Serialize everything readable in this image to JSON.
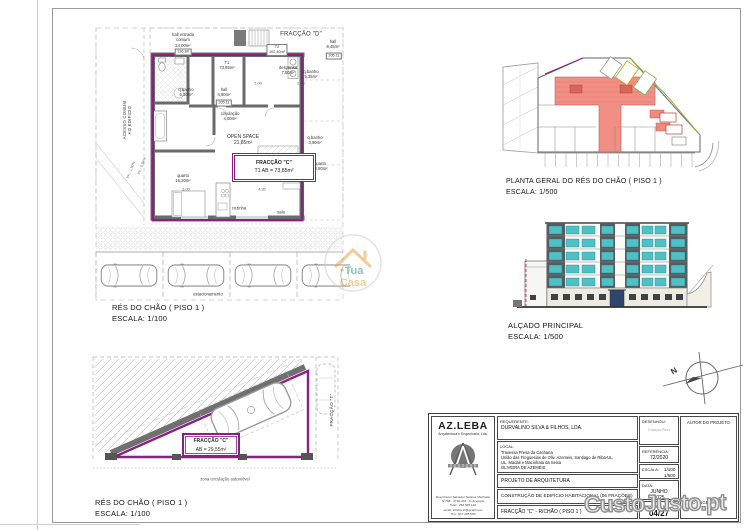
{
  "floorplan": {
    "caption_title": "RÉS DO CHÃO ( PISO 1 )",
    "caption_scale": "ESCALA: 1/100",
    "fraccao_d_title": "FRACÇÃO \"D\"",
    "hall_entrada": "hall entrada\ncomum\n24,00m²",
    "cota_entrada": "136.80",
    "t2_tag": "T2\n102,40m²",
    "t1_tag": "T1\n73,85m²",
    "hall_d": "hall\n6,45m²",
    "cota_hall_d": "205.11",
    "despensa": "despensa\n7,80m²",
    "qbanho_d": "q.banho\n5,35m²",
    "qbanho_d2": "q.banho\n3,90m²",
    "quarto_d": "quarto\n12,80m²",
    "qbanho_c": "q.banho\n6,30m²",
    "hall_c": "hall\n4,90m²",
    "cota_hall_c": "205.11",
    "circulacao": "circulação\n4,00m²",
    "open_space": "OPEN SPACE\n21,85m²",
    "fraccao_c_line1": "FRACÇÃO \"C\"",
    "fraccao_c_line2": "T1  AB = 73,85m²",
    "quarto_c": "quarto\n16,20m²",
    "cozinha": "cozinha",
    "sala": "sala",
    "acesso": "ACESSO COMUM\nAO EDIFÍCIO",
    "inc1": "inc.: 1,90%",
    "inc2": "inc.: 5,94%",
    "estacionamento": "estacionamento",
    "dim1": "2.00",
    "dim2": "2.15",
    "dim3": "3.00",
    "dim4": "4.30"
  },
  "general_plan": {
    "caption_title": "PLANTA GERAL DO RÉS DO CHÃO ( PISO 1 )",
    "caption_scale": "ESCALA: 1/500"
  },
  "elevation": {
    "caption_title": "ALÇADO PRINCIPAL",
    "caption_scale": "ESCALA: 1/500"
  },
  "garage": {
    "caption_title": "RÉS DO CHÃO ( PISO 1 )",
    "caption_scale": "ESCALA: 1/100",
    "fraccao_c_line1": "FRACÇÃO \"C\"",
    "fraccao_c_line2": "AB = 29,55m²",
    "zona": "zona circulação automóvel",
    "fraccao_t": "FRACÇÃO \"T\""
  },
  "north": {
    "label": "N"
  },
  "title_block": {
    "logo_name": "AZ.LEBA",
    "logo_sub": "Arquitectura e Engenharia, Lda.",
    "logo_address": "Rua Doutor Salvador Tavares Machado\nNº788 - 3720-246 - O.Azeméis\nTelef.: 256 665 142\nemail: azleba.zt@gmail.com\nTlm.: 917 295 590",
    "requerente_label": "REQUERENTE:",
    "requerente_value": "DURVALINO SILVA & FILHOS, LDA.",
    "local_label": "LOCAL:",
    "local_value": "Travessa Presa da Cachana\nUnião das Freguesias de Oliv. Azemeis, Santiago de Riba-UL,\nUL, Madail e Macinhata da Seixa\nOLIVEIRA DE AZEMÉIS",
    "projeto": "PROJETO DE ARQUITETURA",
    "obra": "CONSTRUÇÃO DE EDIFÍCIO HABITACIONAL (06 FRAÇÕES)",
    "fraccao": "FRACÇÃO \"C\" - R/CHÃO ( PISO 1 )",
    "desenhou_label": "DESENHOU:",
    "desenhou_value": "Cristina Pires",
    "referencia_label": "REFERÊNCIA:",
    "referencia_value": "72/2020",
    "escala_label": "ESCALA:",
    "escala_value": "1/100\n1/500",
    "data_label": "DATA:",
    "data_value": "JUNHO\n2025",
    "desenho_num_label": "DESENHO Nº:",
    "desenho_num_value": "04/27",
    "autor": "AUTOR DO PROJETO",
    "engenheiro": "O ENGENHEIRO"
  },
  "watermarks": {
    "custojusto": "CustoJusto.pt",
    "tua": "Tua",
    "casa": "Casa"
  },
  "colors": {
    "fraction_outline": "#8b1f86",
    "site_fill": "#f0897e",
    "window_teal": "#4fc0c4"
  }
}
